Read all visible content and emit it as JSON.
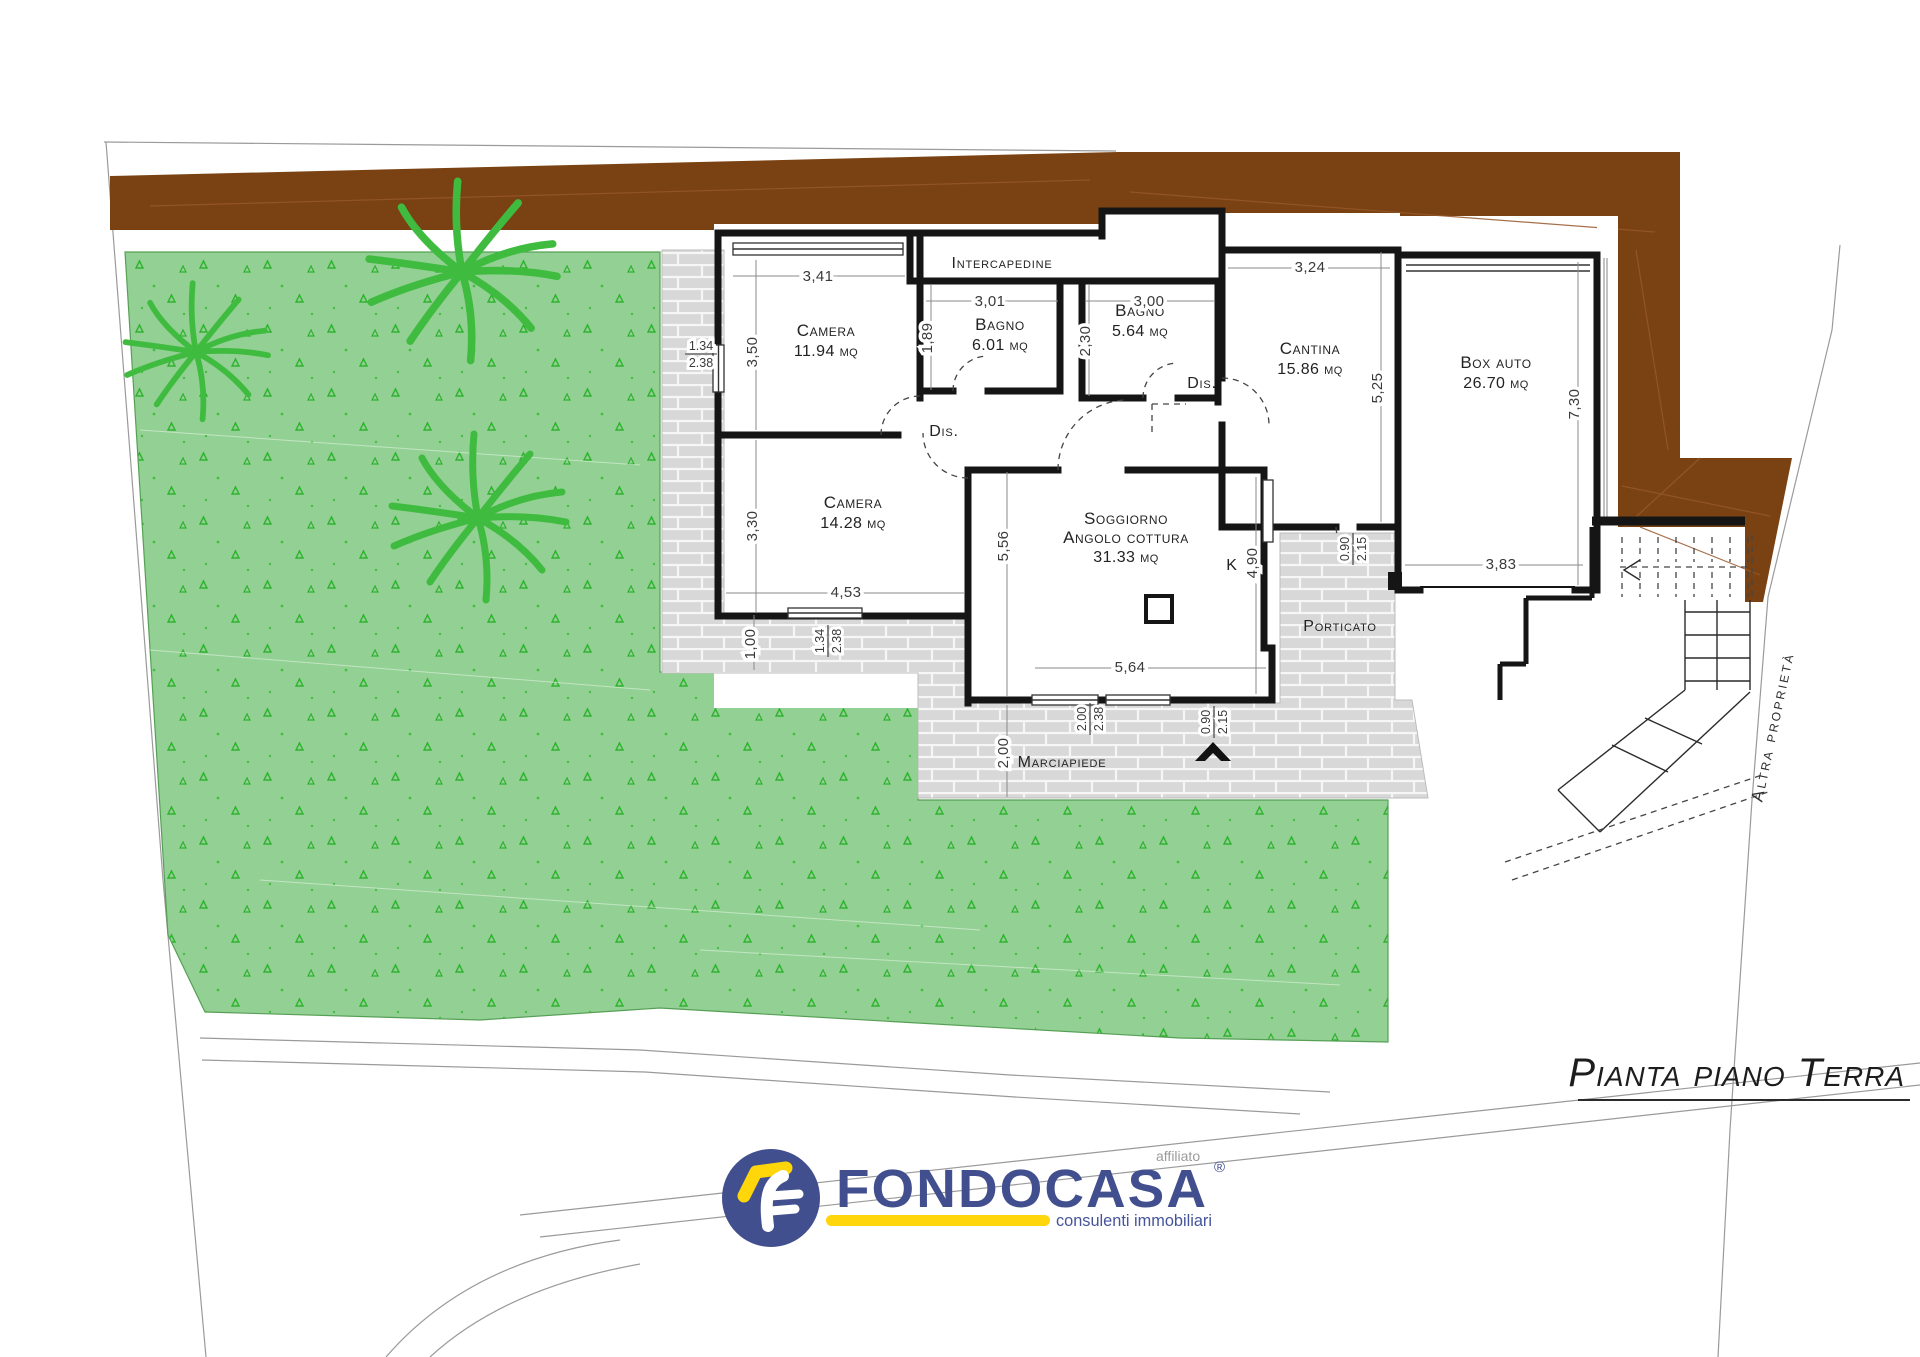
{
  "title": "Pianta piano Terra",
  "rooms": {
    "camera1": {
      "name": "Camera",
      "area": "11.94 mq"
    },
    "bagno1": {
      "name": "Bagno",
      "area": "6.01 mq"
    },
    "bagno2": {
      "name": "Bagno",
      "area": "5.64 mq"
    },
    "cantina": {
      "name": "Cantina",
      "area": "15.86 mq"
    },
    "box_auto": {
      "name": "Box auto",
      "area": "26.70 mq"
    },
    "camera2": {
      "name": "Camera",
      "area": "14.28 mq"
    },
    "soggiorno": {
      "name": "Soggiorno",
      "line2": "Angolo cottura",
      "area": "31.33 mq"
    }
  },
  "labels": {
    "intercapedine": "Intercapedine",
    "dis": "Dis.",
    "kitchen": "K",
    "porticato": "Porticato",
    "marciapiede": "Marciapiede",
    "altra_proprieta": "Altra proprietà"
  },
  "dims": {
    "d341": "3,41",
    "d350": "3,50",
    "d189": "1,89",
    "d301": "3,01",
    "d300": "3,00",
    "d230": "2,30",
    "d324": "3,24",
    "d525": "5,25",
    "d730": "7,30",
    "d383": "3,83",
    "d453": "4,53",
    "d330": "3,30",
    "d556": "5,56",
    "d490": "4,90",
    "d564": "5,64",
    "d100": "1,00",
    "d200": "2,00"
  },
  "openings": {
    "win_west": {
      "w": "1.34",
      "h": "2.38"
    },
    "win_camera2": {
      "w": "1.34",
      "h": "2.38"
    },
    "win_soggiorno": {
      "w": "2.00",
      "h": "2.38"
    },
    "door_main": {
      "w": "0.90",
      "h": "2.15"
    },
    "door_cantina": {
      "w": "0.90",
      "h": "2.15"
    }
  },
  "logo": {
    "brand": "FONDOCASA",
    "affiliato": "affiliato",
    "registered": "®",
    "tagline": "consulenti immobiliari"
  },
  "colors": {
    "wall_brown": "#7a4212",
    "garden_green": "#93d093",
    "leaf_green": "#3fbc3f",
    "paving_gray": "#d8d8d8",
    "logo_blue": "#414f8e",
    "logo_yellow": "#ffd60a"
  }
}
